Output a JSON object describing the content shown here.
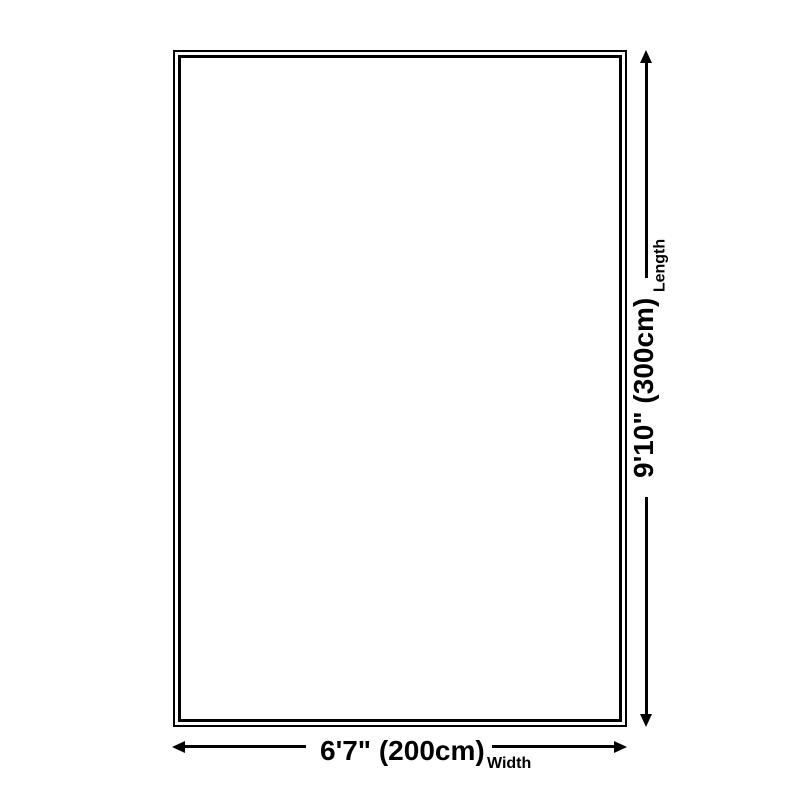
{
  "diagram": {
    "type": "product-dimension-diagram",
    "background_color": "#ffffff",
    "line_color": "#000000",
    "rug": {
      "border_style": "double"
    },
    "length": {
      "value": "9'10\" (300cm)",
      "label": "Length"
    },
    "width": {
      "value": "6'7\" (200cm)",
      "label": "Width"
    },
    "icons": {
      "arrow_up": "triangle-up",
      "arrow_down": "triangle-down",
      "arrow_left": "triangle-left",
      "arrow_right": "triangle-right"
    }
  }
}
